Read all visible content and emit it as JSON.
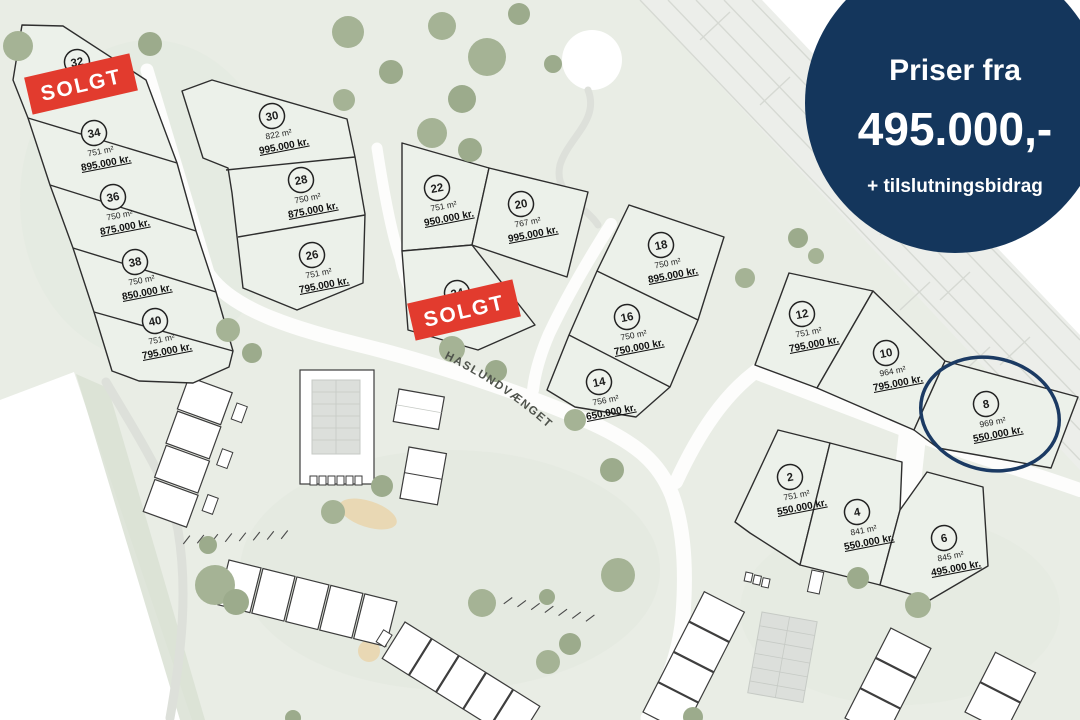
{
  "map": {
    "street": {
      "name": "HASLUNDVÆNGET"
    },
    "sold": {
      "label": "SOLGT",
      "color": "#e23b2e"
    },
    "colors": {
      "site_green": "#e9ede5",
      "lot_fill": "#ecf1ea",
      "navy": "#14365c",
      "tree_green": "#a5b395",
      "sold_red": "#e23b2e"
    },
    "highlighted_lot": "8"
  },
  "badge": {
    "line1": "Priser fra",
    "line2": "495.000,-",
    "line3": "+ tilslutningsbidrag",
    "bg_color": "#14365c",
    "text_color": "#ffffff"
  },
  "lots": [
    {
      "number": "32",
      "sold": true
    },
    {
      "number": "34",
      "area": "751 m²",
      "price": "895.000 kr."
    },
    {
      "number": "36",
      "area": "750 m²",
      "price": "875.000 kr."
    },
    {
      "number": "38",
      "area": "750 m²",
      "price": "850.000 kr."
    },
    {
      "number": "40",
      "area": "751 m²",
      "price": "795.000 kr."
    },
    {
      "number": "30",
      "area": "822 m²",
      "price": "995.000 kr."
    },
    {
      "number": "28",
      "area": "750 m²",
      "price": "875.000 kr."
    },
    {
      "number": "26",
      "area": "751 m²",
      "price": "795.000 kr."
    },
    {
      "number": "22",
      "area": "751 m²",
      "price": "950.000 kr."
    },
    {
      "number": "20",
      "area": "767 m²",
      "price": "995.000 kr."
    },
    {
      "number": "24",
      "sold": true
    },
    {
      "number": "18",
      "area": "750 m²",
      "price": "895.000 kr."
    },
    {
      "number": "16",
      "area": "750 m²",
      "price": "750.000 kr."
    },
    {
      "number": "14",
      "area": "756 m²",
      "price": "650.000 kr."
    },
    {
      "number": "12",
      "area": "751 m²",
      "price": "795.000 kr."
    },
    {
      "number": "10",
      "area": "964 m²",
      "price": "795.000 kr."
    },
    {
      "number": "8",
      "area": "969 m²",
      "price": "550.000 kr.",
      "highlighted": true
    },
    {
      "number": "2",
      "area": "751 m²",
      "price": "550.000 kr."
    },
    {
      "number": "4",
      "area": "841 m²",
      "price": "550.000 kr."
    },
    {
      "number": "6",
      "area": "845 m²",
      "price": "495.000 kr."
    }
  ]
}
